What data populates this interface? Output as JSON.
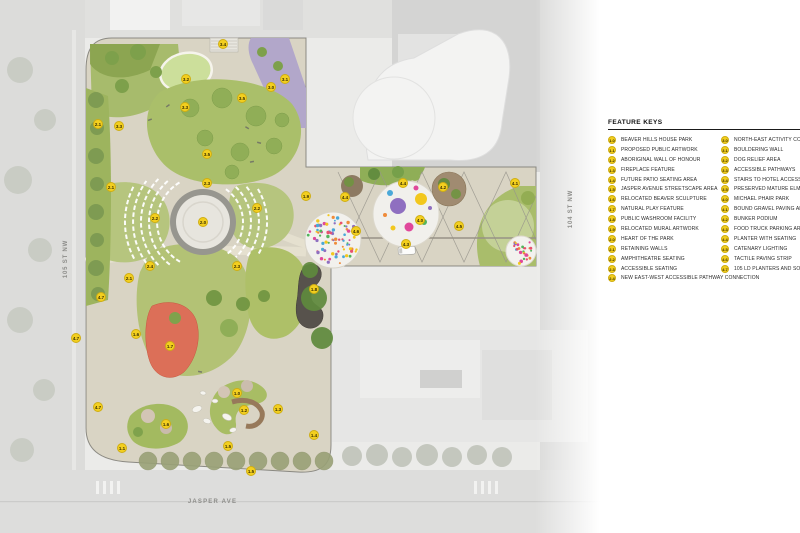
{
  "streets": {
    "west": "105 ST NW",
    "east": "104 ST NW",
    "south": "JASPER AVE"
  },
  "legend": {
    "title": "FEATURE KEYS",
    "columns": [
      {
        "items": [
          {
            "key": "1.0",
            "label": "BEAVER HILLS HOUSE PARK"
          },
          {
            "key": "1.1",
            "label": "PROPOSED PUBLIC ARTWORK"
          },
          {
            "key": "1.2",
            "label": "ABORIGINAL WALL OF HONOUR"
          },
          {
            "key": "1.3",
            "label": "FIREPLACE FEATURE"
          },
          {
            "key": "1.4",
            "label": "FUTURE PATIO SEATING AREA"
          },
          {
            "key": "1.5",
            "label": "JASPER AVENUE STREETSCAPE AREA"
          },
          {
            "key": "1.6",
            "label": "RELOCATED BEAVER SCULPTURE"
          },
          {
            "key": "1.7",
            "label": "NATURAL PLAY FEATURE"
          },
          {
            "key": "1.8",
            "label": "PUBLIC WASHROOM FACILITY"
          },
          {
            "key": "1.9",
            "label": "RELOCATED MURAL ARTWORK"
          },
          {
            "key": "2.0",
            "label": "HEART OF THE PARK"
          },
          {
            "key": "2.1",
            "label": "RETAINING WALLS"
          },
          {
            "key": "2.2",
            "label": "AMPHITHEATRE SEATING"
          },
          {
            "key": "2.3",
            "label": "ACCESSIBLE SEATING"
          },
          {
            "key": "2.4",
            "label": "NEW EAST-WEST ACCESSIBLE PATHWAY CONNECTION"
          }
        ]
      },
      {
        "items": [
          {
            "key": "3.0",
            "label": "NORTH-EAST ACTIVITY CORNER"
          },
          {
            "key": "3.1",
            "label": "BOULDERING WALL"
          },
          {
            "key": "3.2",
            "label": "DOG RELIEF AREA"
          },
          {
            "key": "3.3",
            "label": "ACCESSIBLE PATHWAYS"
          },
          {
            "key": "3.4",
            "label": "STAIRS TO HOTEL ACCESS"
          },
          {
            "key": "3.5",
            "label": "PRESERVED MATURE ELMS"
          },
          {
            "key": "4.0",
            "label": "MICHAEL PHAIR PARK"
          },
          {
            "key": "4.1",
            "label": "BOUND GRAVEL PAVING AREA"
          },
          {
            "key": "4.2",
            "label": "BUNKER PODIUM"
          },
          {
            "key": "4.3",
            "label": "FOOD TRUCK PARKING AREA"
          },
          {
            "key": "4.4",
            "label": "PLANTER WITH SEATING"
          },
          {
            "key": "4.5",
            "label": "CATENARY LIGHTING"
          },
          {
            "key": "4.6",
            "label": "TACTILE PAVING STRIP"
          },
          {
            "key": "4.7",
            "label": "105 LD PLANTERS AND SOIL CELLS"
          }
        ]
      }
    ]
  },
  "badges": [
    {
      "key": "3.4",
      "x": 223,
      "y": 44
    },
    {
      "key": "3.2",
      "x": 186,
      "y": 79
    },
    {
      "key": "3.1",
      "x": 285,
      "y": 79
    },
    {
      "key": "3.0",
      "x": 271,
      "y": 87
    },
    {
      "key": "3.5",
      "x": 242,
      "y": 98
    },
    {
      "key": "3.3",
      "x": 185,
      "y": 107
    },
    {
      "key": "2.1",
      "x": 98,
      "y": 124
    },
    {
      "key": "3.3",
      "x": 119,
      "y": 126
    },
    {
      "key": "3.5",
      "x": 207,
      "y": 154
    },
    {
      "key": "2.3",
      "x": 207,
      "y": 183
    },
    {
      "key": "2.1",
      "x": 111,
      "y": 187
    },
    {
      "key": "1.9",
      "x": 306,
      "y": 196
    },
    {
      "key": "2.2",
      "x": 155,
      "y": 218
    },
    {
      "key": "2.2",
      "x": 257,
      "y": 208
    },
    {
      "key": "2.0",
      "x": 203,
      "y": 222
    },
    {
      "key": "2.3",
      "x": 237,
      "y": 266
    },
    {
      "key": "2.4",
      "x": 150,
      "y": 266
    },
    {
      "key": "2.1",
      "x": 129,
      "y": 278
    },
    {
      "key": "4.7",
      "x": 101,
      "y": 297
    },
    {
      "key": "1.8",
      "x": 314,
      "y": 289
    },
    {
      "key": "1.6",
      "x": 136,
      "y": 334
    },
    {
      "key": "4.7",
      "x": 76,
      "y": 338
    },
    {
      "key": "1.7",
      "x": 170,
      "y": 346
    },
    {
      "key": "1.0",
      "x": 237,
      "y": 393
    },
    {
      "key": "4.7",
      "x": 98,
      "y": 407
    },
    {
      "key": "1.2",
      "x": 244,
      "y": 410
    },
    {
      "key": "1.3",
      "x": 278,
      "y": 409
    },
    {
      "key": "1.6",
      "x": 166,
      "y": 424
    },
    {
      "key": "1.4",
      "x": 314,
      "y": 435
    },
    {
      "key": "1.5",
      "x": 228,
      "y": 446
    },
    {
      "key": "1.1",
      "x": 122,
      "y": 448
    },
    {
      "key": "1.5",
      "x": 251,
      "y": 471
    },
    {
      "key": "4.4",
      "x": 345,
      "y": 197
    },
    {
      "key": "4.4",
      "x": 403,
      "y": 183
    },
    {
      "key": "4.2",
      "x": 443,
      "y": 187
    },
    {
      "key": "4.1",
      "x": 515,
      "y": 183
    },
    {
      "key": "4.0",
      "x": 420,
      "y": 220
    },
    {
      "key": "4.5",
      "x": 459,
      "y": 226
    },
    {
      "key": "4.6",
      "x": 356,
      "y": 231
    },
    {
      "key": "4.3",
      "x": 406,
      "y": 244
    }
  ],
  "colors": {
    "badge_yellow": "#f3cf1f",
    "park_paving": "#d9d4c4",
    "lawn_green": "#aabf6a",
    "dog_relief_purple": "#b2a7ca",
    "play_feature_red": "#dc6f58",
    "washroom_dark": "#57524c",
    "confetti_palette": [
      "#e8506e",
      "#f2c71d",
      "#4aa8d8",
      "#8f6fc0",
      "#52b45c",
      "#ef8b3a",
      "#e0489b"
    ]
  }
}
